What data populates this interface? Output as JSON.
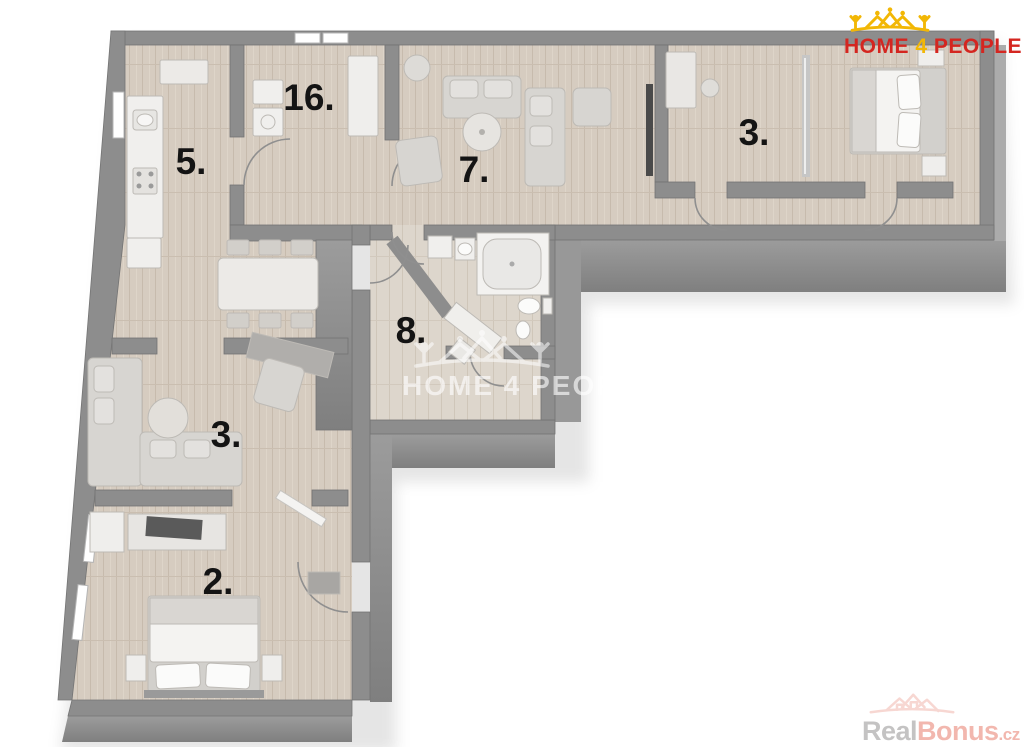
{
  "page": {
    "type": "real-estate-3d-floor-plan",
    "background": "#ffffff"
  },
  "branding": {
    "logo": {
      "word1": "HOME",
      "word2": "4",
      "word3": "PEOPLE",
      "text_color": "#d42620",
      "accent_color": "#f2b705",
      "icon": "houses-crown-icon"
    },
    "center_watermark": {
      "text": "HOME 4 PEOPLE",
      "icon": "houses-crown-outline-icon"
    },
    "corner_watermark": {
      "word1": "Real",
      "word2": "Bonus",
      "word3": ".cz",
      "word1_color": "#c4c3c3",
      "word2_color": "#f2b7ae",
      "icon": "house-outline-icon"
    }
  },
  "floor_plan": {
    "room_labels": [
      {
        "id": "16",
        "label": "16."
      },
      {
        "id": "5",
        "label": "5."
      },
      {
        "id": "7",
        "label": "7."
      },
      {
        "id": "3-top",
        "label": "3."
      },
      {
        "id": "8",
        "label": "8."
      },
      {
        "id": "3-left",
        "label": "3."
      },
      {
        "id": "2",
        "label": "2."
      }
    ],
    "colors": {
      "wall": "#8d8d8d",
      "wall_face_dark": "#828282",
      "floor_wood": "#d6ccc0",
      "floor_light": "#ddd6cc",
      "furniture_white": "#f0efed",
      "furniture_gray": "#d7d5d1",
      "label_text": "#141414"
    }
  }
}
